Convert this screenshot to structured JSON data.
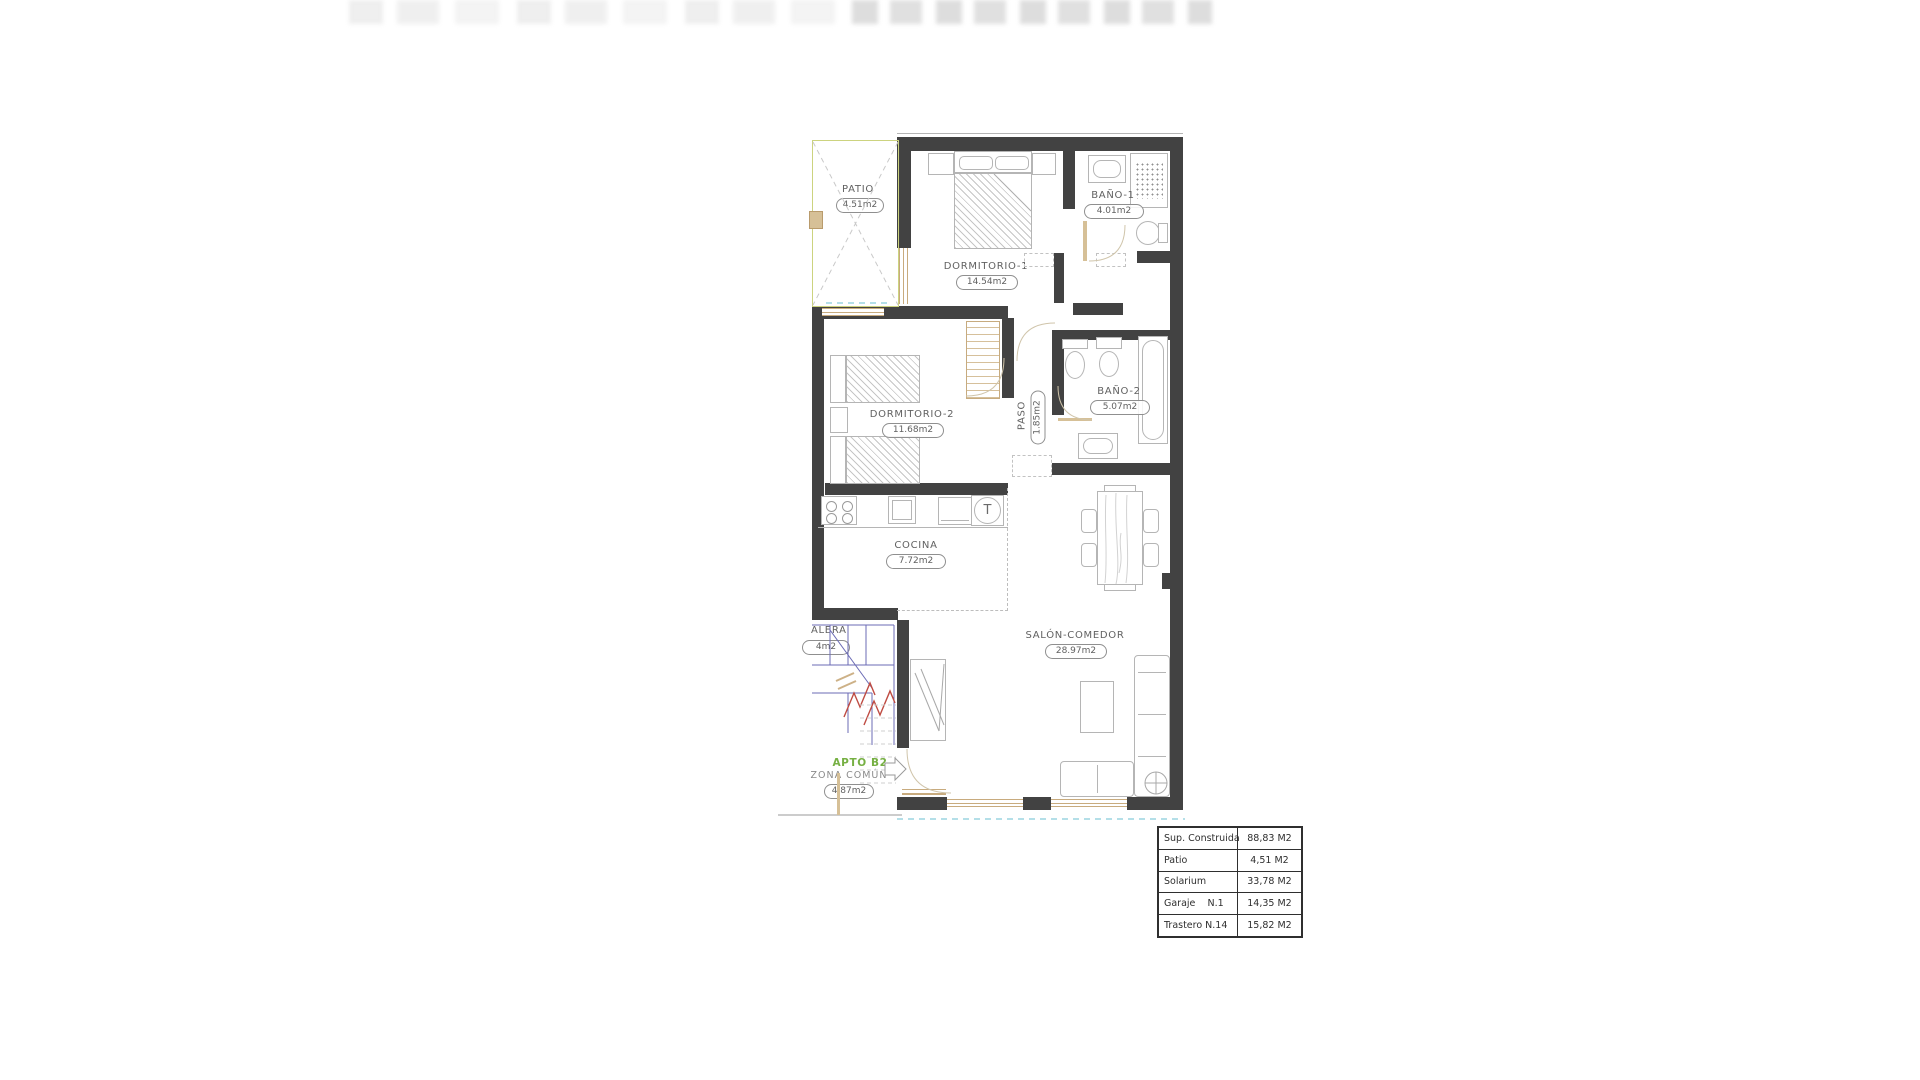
{
  "rooms": {
    "patio": {
      "label": "PATIO",
      "area": "4.51m2"
    },
    "dormitorio1": {
      "label": "DORMITORIO-1",
      "area": "14.54m2"
    },
    "bano1": {
      "label": "BAÑO-1",
      "area": "4.01m2"
    },
    "dormitorio2": {
      "label": "DORMITORIO-2",
      "area": "11.68m2"
    },
    "paso": {
      "label": "PASO",
      "area": "1.85m2"
    },
    "bano2": {
      "label": "BAÑO-2",
      "area": "5.07m2"
    },
    "cocina": {
      "label": "COCINA",
      "area": "7.72m2"
    },
    "salon": {
      "label": "SALÓN-COMEDOR",
      "area": "28.97m2"
    },
    "escalera": {
      "label": "ALERA",
      "area": "4m2"
    },
    "zona_comun": {
      "label": "ZONA COMÚN",
      "area": "4.87m2"
    }
  },
  "apartment": {
    "tag": "APTO B2"
  },
  "kitchen": {
    "symbol": "T"
  },
  "summary_table": {
    "rows": [
      {
        "name": "Sup. Construida",
        "value": "88,83 M2"
      },
      {
        "name": "Patio",
        "value": "4,51 M2"
      },
      {
        "name": "Solarium",
        "value": "33,78 M2"
      },
      {
        "name": "Garaje    N.1",
        "value": "14,35 M2"
      },
      {
        "name": "Trastero N.14",
        "value": "15,82 M2"
      }
    ]
  },
  "palette": {
    "wall_dark": "#424242",
    "apto_green": "#76b043",
    "patio_outline": "#ccd37f",
    "stair_blue": "#6b6bb5",
    "arrow_red": "#bf4b42",
    "terrace_cyan": "#86ccd9",
    "wood_beige": "#d6c097"
  }
}
